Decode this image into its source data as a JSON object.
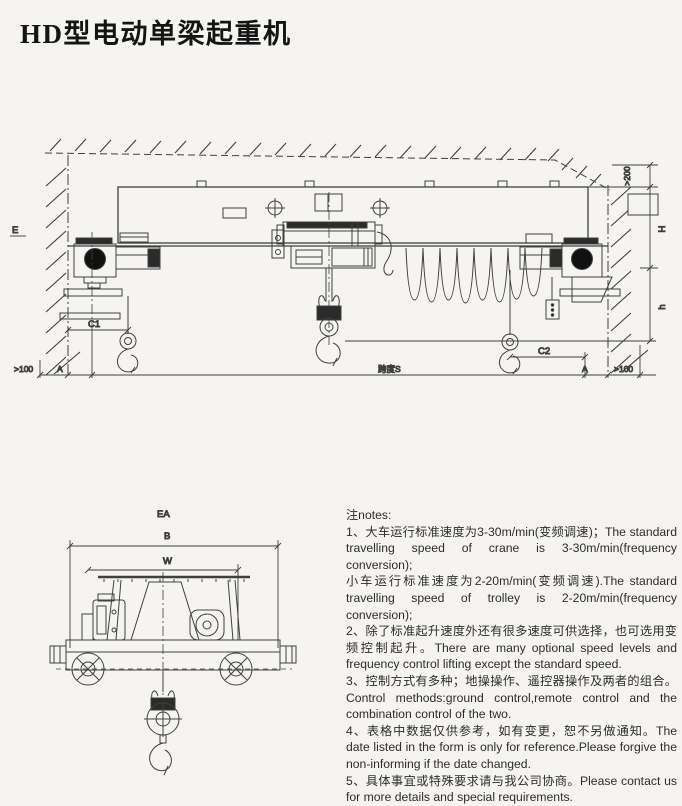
{
  "page": {
    "title": "HD型电动单梁起重机",
    "background_color": "#f5f4f0",
    "line_color": "#3f3f3f"
  },
  "main_drawing": {
    "description": "front elevation of HD type electric single girder crane between two walls with ceiling",
    "labels": {
      "hoist_side": "E",
      "wall_clearance_left": ">100",
      "rail_offset_left": "A",
      "hook_approach_left": "C1",
      "span": "跨度S",
      "hook_approach_right": "C2",
      "rail_offset_right": "A",
      "wall_clearance_right": ">100",
      "top_clearance": ">200",
      "lift_height_upper": "H",
      "lift_height_lower": "h"
    }
  },
  "side_drawing": {
    "description": "end view of crane girder with low-headroom hoist trolley and hook",
    "labels": {
      "overall_width": "EA",
      "base_width": "B",
      "wheel_gauge": "W"
    }
  },
  "notes": {
    "heading": "注notes:",
    "items": [
      "1、大车运行标准速度为3-30m/min(变频调速)；The standard travelling speed of crane is 3-30m/min(frequency conversion);",
      "小车运行标准速度为2-20m/min(变频调速).The standard travelling speed of trolley is 2-20m/min(frequency conversion);",
      "2、除了标准起升速度外还有很多速度可供选择，也可选用变频控制起升。There are many optional speed levels and frequency control lifting except the standard speed.",
      "3、控制方式有多种；地操操作、遥控器操作及两者的组合。Control methods:ground control,remote control and the combination control of the two.",
      "4、表格中数据仅供参考，如有变更，恕不另做通知。The date listed in the form is only for reference.Please forgive the non-informing if the date changed.",
      "5、具体事宜或特殊要求请与我公司协商。Please contact us for more details and special requirements."
    ]
  }
}
